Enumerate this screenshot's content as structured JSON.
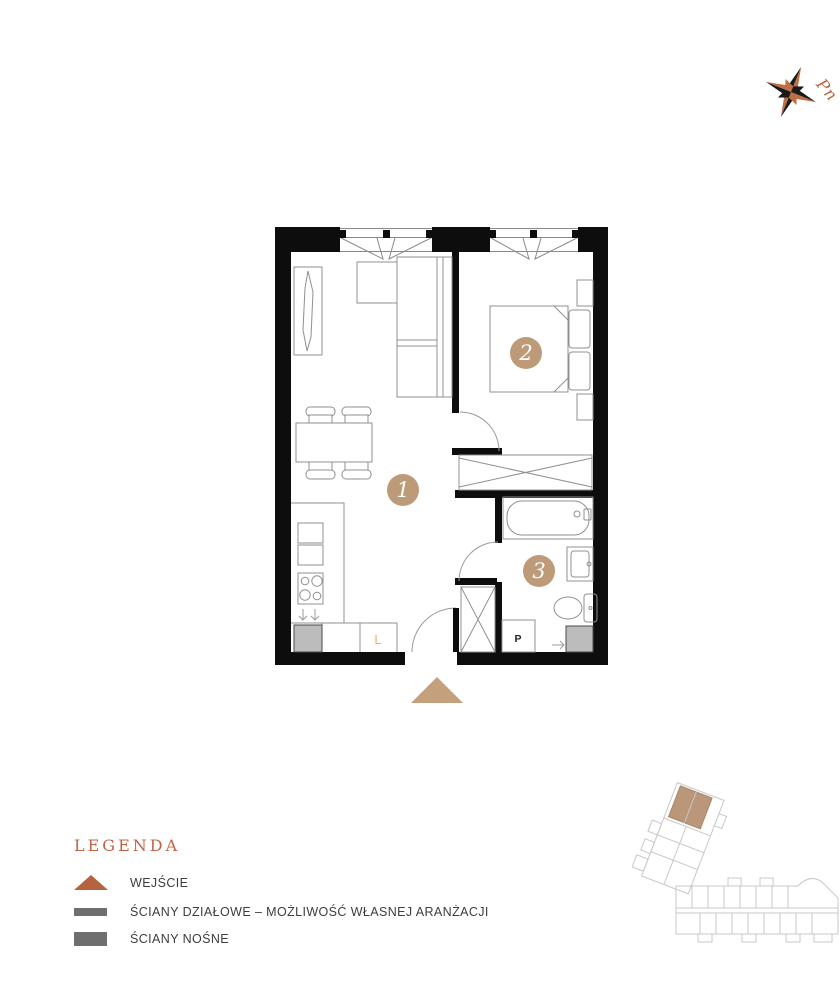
{
  "compass": {
    "north_label": "Pn",
    "accent_color": "#b5643c"
  },
  "floor_plan": {
    "rooms": [
      {
        "number": "1"
      },
      {
        "number": "2"
      },
      {
        "number": "3"
      }
    ],
    "appliance_labels": {
      "fridge": "L",
      "washing_machine": "P"
    },
    "room_badge_color": "#bd9a78",
    "entrance_marker_color": "#c4a17c",
    "wall_color": "#0d0d0d"
  },
  "legend": {
    "title": "LEGENDA",
    "items": [
      {
        "id": "entrance",
        "label": "WEJŚCIE"
      },
      {
        "id": "partition-walls",
        "label": "ŚCIANY DZIAŁOWE – MOŻLIWOŚĆ WŁASNEJ ARANŻACJI"
      },
      {
        "id": "load-bearing-walls",
        "label": "ŚCIANY NOŚNE"
      }
    ],
    "triangle_color": "#b5643f",
    "bar_color": "#6e6e6e"
  }
}
